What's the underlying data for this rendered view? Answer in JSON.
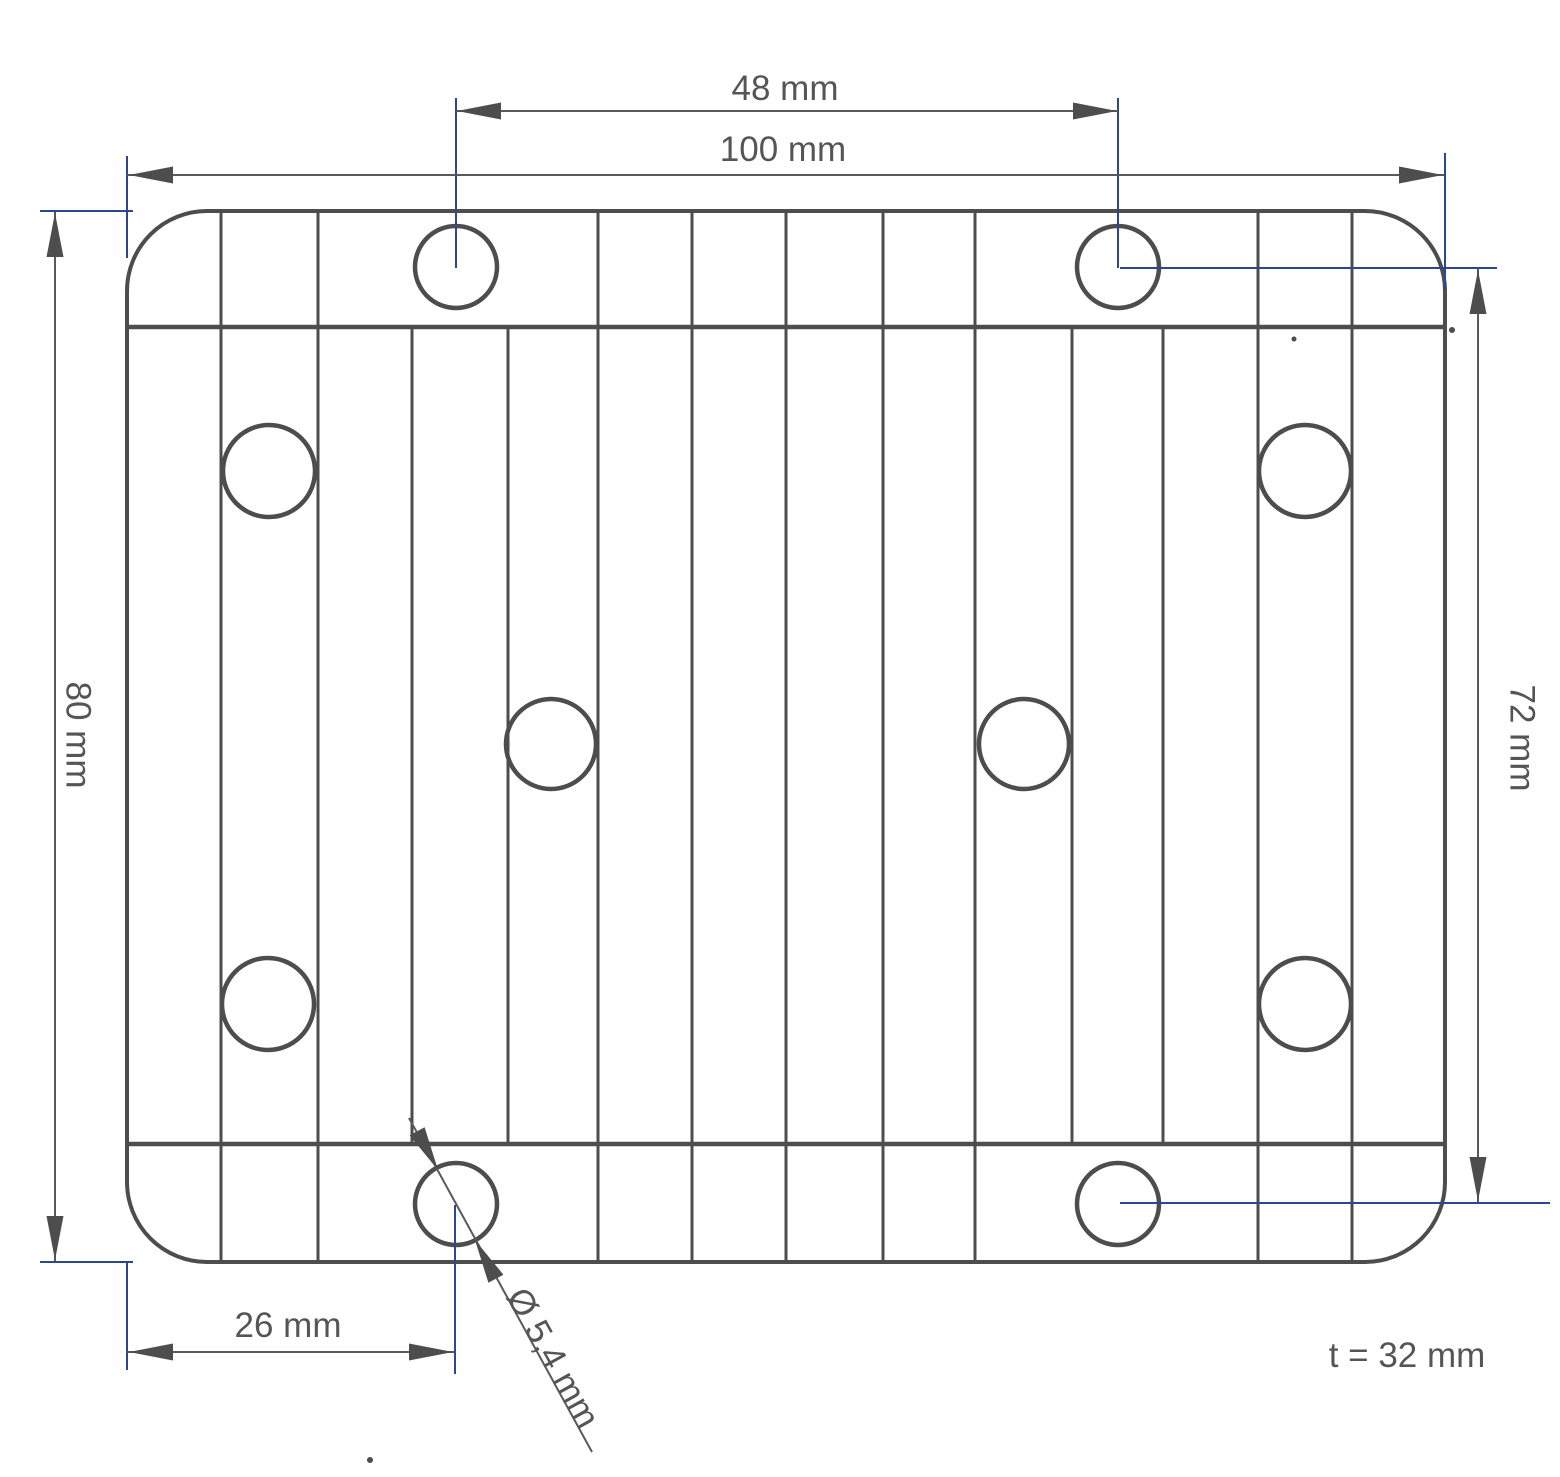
{
  "drawing": {
    "description": "2D technical drawing, top view of a finned plate with ten mounting holes",
    "background_color": "#ffffff",
    "object_line_color": "#4d4d4d",
    "dimension_line_color": "#58595b",
    "extension_line_color": "#2c4790",
    "text_color": "#555555"
  },
  "labels": {
    "hole_pitch_horizontal": "48 mm",
    "overall_width": "100 mm",
    "overall_height": "80 mm",
    "hole_pitch_vertical": "72 mm",
    "hole_offset_left": "26 mm",
    "hole_diameter": "Ø 5,4 mm",
    "thickness": "t = 32 mm"
  }
}
